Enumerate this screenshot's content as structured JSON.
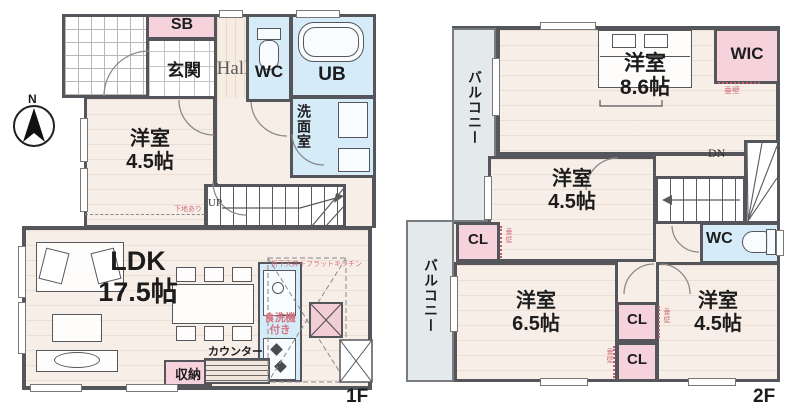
{
  "plan": {
    "type": "house-floor-plan"
  },
  "colors": {
    "wall": "#55565c",
    "floor": "#f7efe7",
    "wet_room": "#d5ebf8",
    "storage_pink": "#f6d2dc",
    "balcony": "#e4e9ec",
    "annotation_pink": "#d4717f"
  },
  "compass": {
    "label": "N"
  },
  "floor1": {
    "floor_label": "1F",
    "entrance": "玄関",
    "shoe_box": "SB",
    "hall": "Hall",
    "toilet": "WC",
    "bath": "UB",
    "washroom": "洗面室",
    "west_room": {
      "name": "洋室",
      "size": "4.5帖"
    },
    "ldk": {
      "name": "LDK",
      "size": "17.5帖"
    },
    "stairs": "UP",
    "storage": "収納",
    "counter": "カウンター",
    "kitchen_note": "食洗機付き",
    "ceiling_note": "折下天井＋フラットキッチン",
    "base_note": "下地あり"
  },
  "floor2": {
    "floor_label": "2F",
    "balcony_upper": "バルコニー",
    "balcony_lower": "バルコニー",
    "west_room_86": {
      "name": "洋室",
      "size": "8.6帖"
    },
    "wic": "WIC",
    "west_room_45_mid": {
      "name": "洋室",
      "size": "4.5帖"
    },
    "stairs": "DN",
    "toilet": "WC",
    "closet_left": "CL",
    "closet_mid_upper": "CL",
    "closet_mid_lower": "CL",
    "west_room_65": {
      "name": "洋室",
      "size": "6.5帖"
    },
    "west_room_45_br": {
      "name": "洋室",
      "size": "4.5帖"
    },
    "hanging_wall_note": "垂壁"
  }
}
